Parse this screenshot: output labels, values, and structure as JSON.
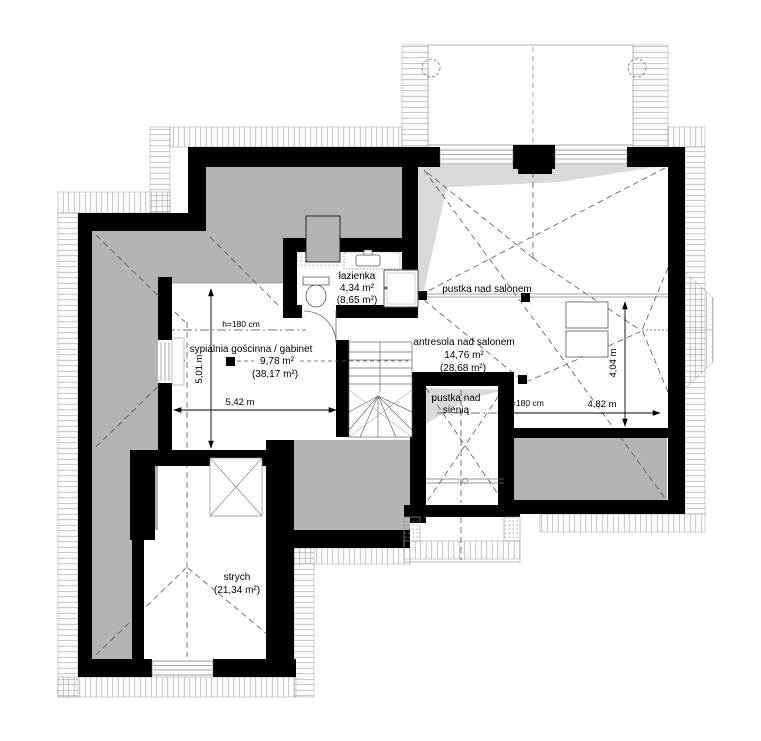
{
  "plan": {
    "title": "attic floor plan",
    "rooms": {
      "bathroom": {
        "name": "łazienka",
        "area": "4,34 m²",
        "area_floor": "(8,65 m²)"
      },
      "bedroom": {
        "name": "sypialnia gościnna / gabinet",
        "area": "9,78 m²",
        "area_floor": "(38,17 m²)"
      },
      "mezzanine": {
        "name": "antresola nad salonem",
        "area": "14,76 m²",
        "area_floor": "(28,68 m²)"
      },
      "void_living": {
        "name": "pustka nad salonem"
      },
      "void_hall": {
        "line1": "pustka nad",
        "line2": "sienią"
      },
      "attic": {
        "name": "strych",
        "area_floor": "(21,34 m²)"
      }
    },
    "dimensions": {
      "v_left": "5,01 m",
      "h_left": "5,42 m",
      "h_right": "4,82 m",
      "v_right": "4,04 m",
      "h180_left": "h=180 cm",
      "h180_right": "h=180 cm"
    },
    "colors": {
      "wall": "#000000",
      "low_headroom": "#b3b3b3",
      "roof_shade": "#d9d9d9",
      "hatch": "#9a9a9a"
    }
  }
}
